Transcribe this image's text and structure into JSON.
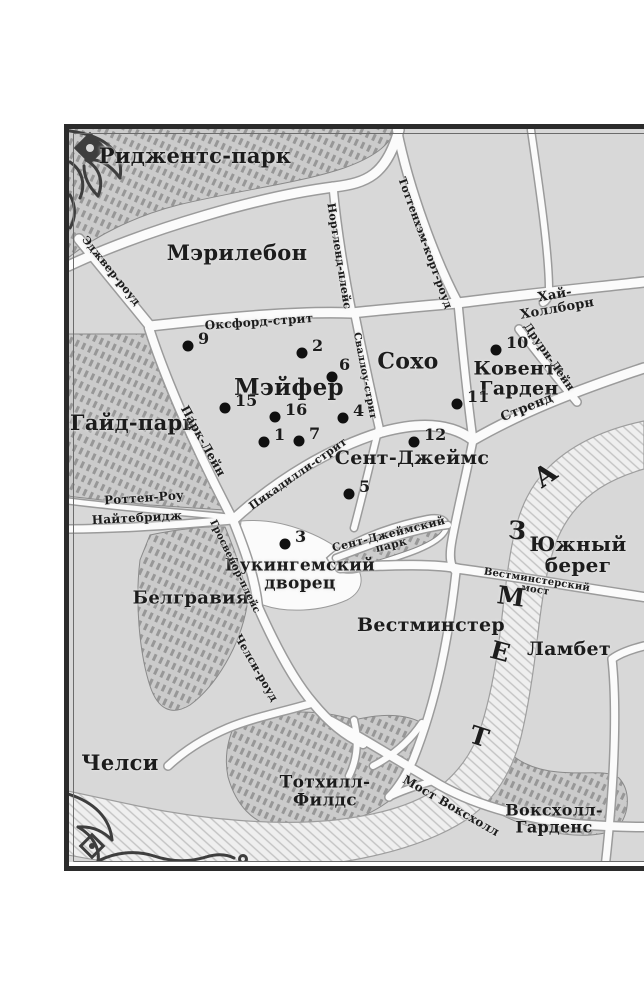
{
  "map": {
    "regions": [
      {
        "id": "regents-park",
        "label": "Риджентс-парк"
      },
      {
        "id": "marylebone",
        "label": "Мэрилебон"
      },
      {
        "id": "soho",
        "label": "Сохо"
      },
      {
        "id": "mayfair",
        "label": "Мэйфер"
      },
      {
        "id": "covent-garden",
        "label": "Ковент-\nГарден"
      },
      {
        "id": "st-james",
        "label": "Сент-Джеймс"
      },
      {
        "id": "hyde-park",
        "label": "Гайд-парк"
      },
      {
        "id": "belgravia",
        "label": "Белгравия"
      },
      {
        "id": "south-bank",
        "label": "Южный берег"
      },
      {
        "id": "westminster",
        "label": "Вестминстер"
      },
      {
        "id": "lambeth",
        "label": "Ламбет"
      },
      {
        "id": "chelsea",
        "label": "Челси"
      },
      {
        "id": "tothill-fields",
        "label": "Тотхилл-\nФилдс"
      },
      {
        "id": "vauxhall-gardens",
        "label": "Воксхолл-\nГарденс"
      },
      {
        "id": "buckingham-palace",
        "label": "Букингемский\nдворец"
      },
      {
        "id": "st-james-park",
        "label": "Сент-Джеймский\nпарк"
      }
    ],
    "streets": [
      {
        "id": "edgware-road",
        "label": "Эджвер-роуд"
      },
      {
        "id": "nortland-place",
        "label": "Нортленд-плейс"
      },
      {
        "id": "tottenham-court-rd",
        "label": "Тоттенхэм-корт-роуд"
      },
      {
        "id": "oxford-street",
        "label": "Оксфорд-стрит"
      },
      {
        "id": "high-holborn",
        "label": "Хай-Холлборн"
      },
      {
        "id": "drury-lane",
        "label": "Друри-Лейн"
      },
      {
        "id": "strand",
        "label": "Стренд"
      },
      {
        "id": "swallow-street",
        "label": "Сваллоу-стрит"
      },
      {
        "id": "park-lane",
        "label": "Парк-Лейн"
      },
      {
        "id": "rotten-row",
        "label": "Роттен-Роу"
      },
      {
        "id": "knightsbridge",
        "label": "Найтебридж"
      },
      {
        "id": "grosvenor-place",
        "label": "Гросвенор-плейс"
      },
      {
        "id": "chelsea-road",
        "label": "Челси-роуд"
      },
      {
        "id": "piccadilly-street",
        "label": "Пикадилли-стрит"
      },
      {
        "id": "westminster-bridge",
        "label": "Вестминстерский мост"
      },
      {
        "id": "vauxhall-bridge",
        "label": "Мост Воксхолл"
      }
    ],
    "river": {
      "name_letters": [
        "Т",
        "Е",
        "М",
        "З",
        "А"
      ]
    },
    "points": [
      {
        "n": "1"
      },
      {
        "n": "2"
      },
      {
        "n": "3"
      },
      {
        "n": "4"
      },
      {
        "n": "5"
      },
      {
        "n": "6"
      },
      {
        "n": "7"
      },
      {
        "n": "9"
      },
      {
        "n": "10"
      },
      {
        "n": "11"
      },
      {
        "n": "12"
      },
      {
        "n": "15"
      },
      {
        "n": "16"
      }
    ]
  },
  "colors": {
    "land": "#d8d8d8",
    "roads": "#fbfbfb",
    "ink": "#1c1c1c",
    "park_hatch": "#999999",
    "river_hatch": "#bfbfbf",
    "border": "#2b2b2b"
  }
}
